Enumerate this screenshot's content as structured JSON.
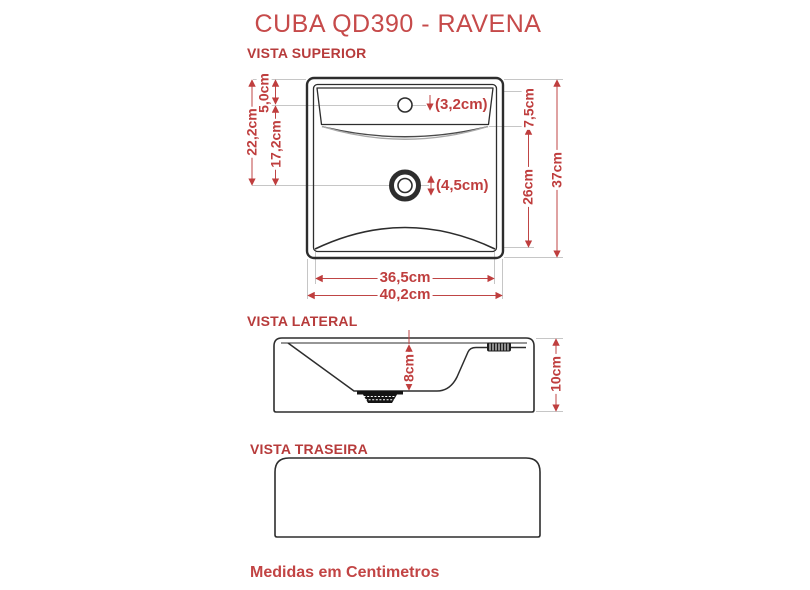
{
  "title": "CUBA QD390 - RAVENA",
  "footer": "Medidas em Centimetros",
  "colors": {
    "accent": "#bf3e3e",
    "line": "#2d2d2d",
    "extension": "#c6c6c6"
  },
  "views": {
    "superior": {
      "label": "VISTA SUPERIOR",
      "dims": {
        "left_total": "22,2cm",
        "left_top": "5,0cm",
        "left_mid": "17,2cm",
        "faucet_hole": "(3,2cm)",
        "drain_hole": "(4,5cm)",
        "right_top": "7,5cm",
        "right_mid": "26cm",
        "right_total": "37cm",
        "bottom_inner": "36,5cm",
        "bottom_outer": "40,2cm"
      }
    },
    "lateral": {
      "label": "VISTA LATERAL",
      "dims": {
        "bowl_depth": "8cm",
        "total_height": "10cm"
      }
    },
    "traseira": {
      "label": "VISTA TRASEIRA"
    }
  }
}
